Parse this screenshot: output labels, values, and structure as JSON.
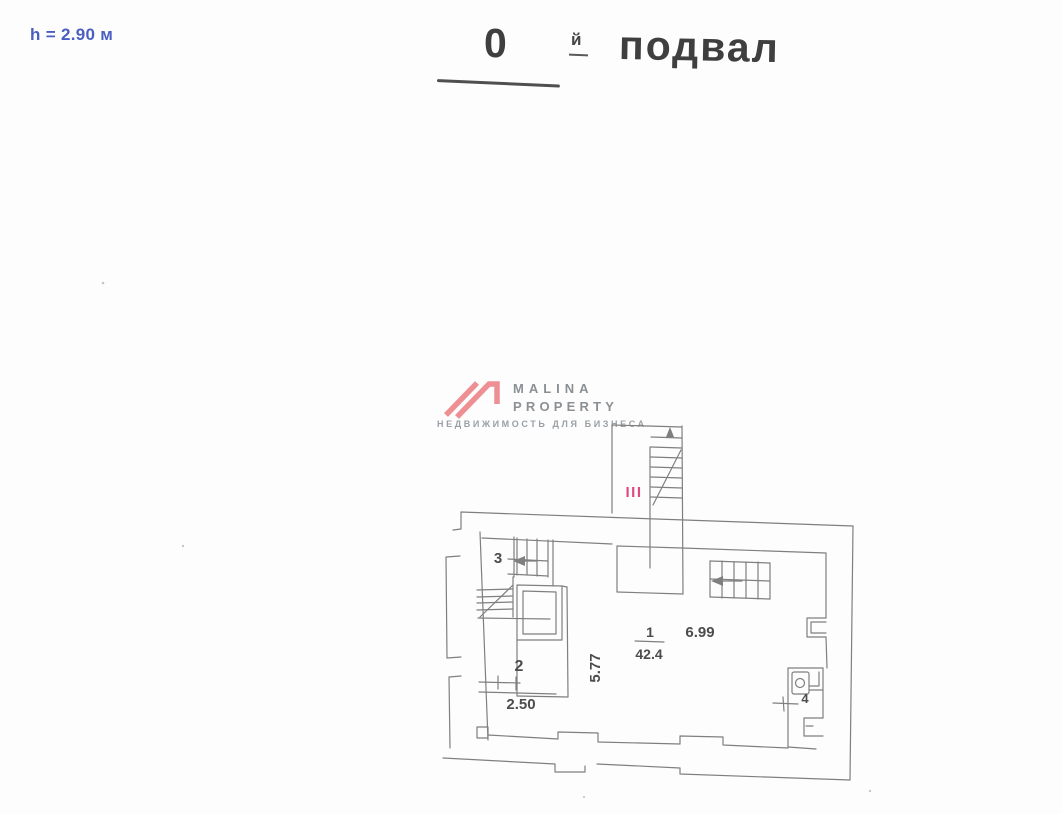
{
  "header": {
    "height_note": "h = 2.90 м",
    "floor_number": "0",
    "floor_suffix": "й",
    "floor_name": "подвал"
  },
  "logo": {
    "line1": "MALINA",
    "line2": "PROPERTY",
    "tagline": "НЕДВИЖИМОСТЬ ДЛЯ БИЗНЕСА"
  },
  "plan_labels": {
    "entrance_stair_mark": "III",
    "room3_number": "3",
    "room2_number": "2",
    "room2_width": "2.50",
    "room1_depth": "5.77",
    "room1_number": "1",
    "room1_area": "42.4",
    "room1_width": "6.99",
    "room4_number": "4"
  },
  "colors": {
    "accent_blue": "#4a5ec2",
    "title_gray": "#3f3f3f",
    "logo_pink": "#ee8f94",
    "logo_text_gray": "#8b9095",
    "stair_mark_pink": "#e0487e",
    "plan_line_gray": "#7f7f7f"
  }
}
